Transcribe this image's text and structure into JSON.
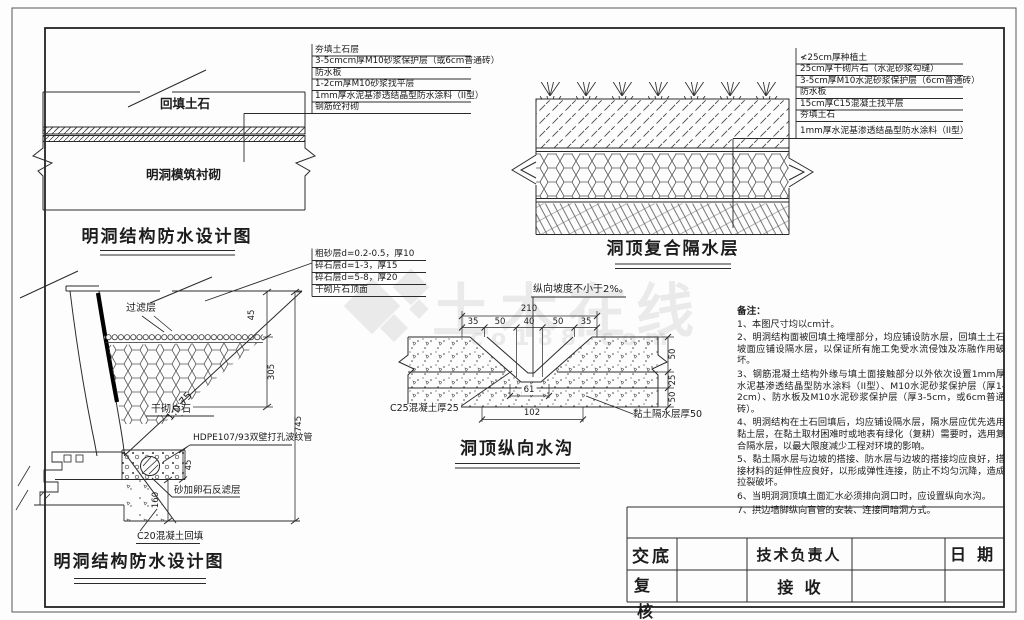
{
  "watermark": {
    "brand": "土木在线",
    "domain": "co188.com"
  },
  "d1": {
    "title": "明洞结构防水设计图",
    "backfill": "回填土石",
    "lining": "明洞模筑衬砌",
    "callouts": [
      "夯填土石层",
      "3-5cmcm厚M10砂浆保护层（或6cm普通砖）",
      "防水板",
      "1-2cm厚M10砂浆找平层",
      "1mm厚水泥基渗透结晶型防水涂料（II型）",
      "钢筋砼衬砌"
    ]
  },
  "stack": [
    "粗砂层d=0.2-0.5，厚10",
    "碎石层d=1-3，厚15",
    "碎石层d=5-8，厚20",
    "干砌片石顶面"
  ],
  "d2": {
    "title": "洞顶复合隔水层",
    "callouts": [
      "≮25cm厚种植土",
      "25cm厚干砌片石（水泥砂浆勾缝）",
      "3-5cm厚M10水泥砂浆保护层（6cm普通砖）",
      "防水板",
      "15cm厚C15混凝土找平层",
      "夯填土石",
      "1mm厚水泥基渗透结晶型防水涂料（II型）"
    ]
  },
  "d3": {
    "title": "明洞结构防水设计图",
    "filter": "过滤层",
    "drystone": "干砌片石",
    "slope": "1:0.75",
    "pipe": "HDPE107/93双壁打孔波纹管",
    "sand": "砂加卵石反滤层",
    "c20": "C20混凝土回填",
    "dims": {
      "a45": "45",
      "a305": "305",
      "a745": "745",
      "b45": "45",
      "b160": "160"
    }
  },
  "d4": {
    "title": "洞顶纵向水沟",
    "slope_note": "纵向坡度不小于2%。",
    "total": "210",
    "top_dims": [
      "35",
      "50",
      "40",
      "50",
      "35"
    ],
    "right_dims": [
      "50",
      "25",
      "50"
    ],
    "bottom_dims": [
      "61",
      "102"
    ],
    "c25": "C25混凝土厚25",
    "clay": "黏土隔水层厚50"
  },
  "notes": {
    "heading": "备注：",
    "items": [
      "1、本图尺寸均以cm计。",
      "2、明洞结构面被回填土掩埋部分，均应铺设防水层，回填土土石坡面应铺设隔水层，以保证所有施工免受水流侵蚀及冻融作用破坏。",
      "3、钢筋混凝土结构外缘与填土面接触部分以外依次设置1mm厚水泥基渗透结晶型防水涂料（II型）、M10水泥砂浆保护层（厚1-2cm）、防水板及M10水泥砂浆保护层（厚3-5cm，或6cm普通砖）。",
      "4、明洞结构在土石回填后，均应铺设隔水层，隔水层应优先选用黏土层，在黏土取材困难时或地表有绿化（复耕）需要时，选用复合隔水层，以最大限度减少工程对环境的影响。",
      "5、黏土隔水层与边坡的搭接、防水层与边坡的搭接均应良好，搭接材料的延伸性应良好，以形成弹性连接，防止不均匀沉降，造成拉裂破坏。",
      "6、当明洞洞顶填土面汇水必须排向洞口时，应设置纵向水沟。",
      "7、拱边墙脚纵向盲管的安装、连接同暗洞方式。"
    ]
  },
  "tb": {
    "jiaodi": "交底",
    "fu": "复",
    "he": "核",
    "tech": "技术负责人",
    "jieshou": "接  收",
    "date": "日  期"
  }
}
